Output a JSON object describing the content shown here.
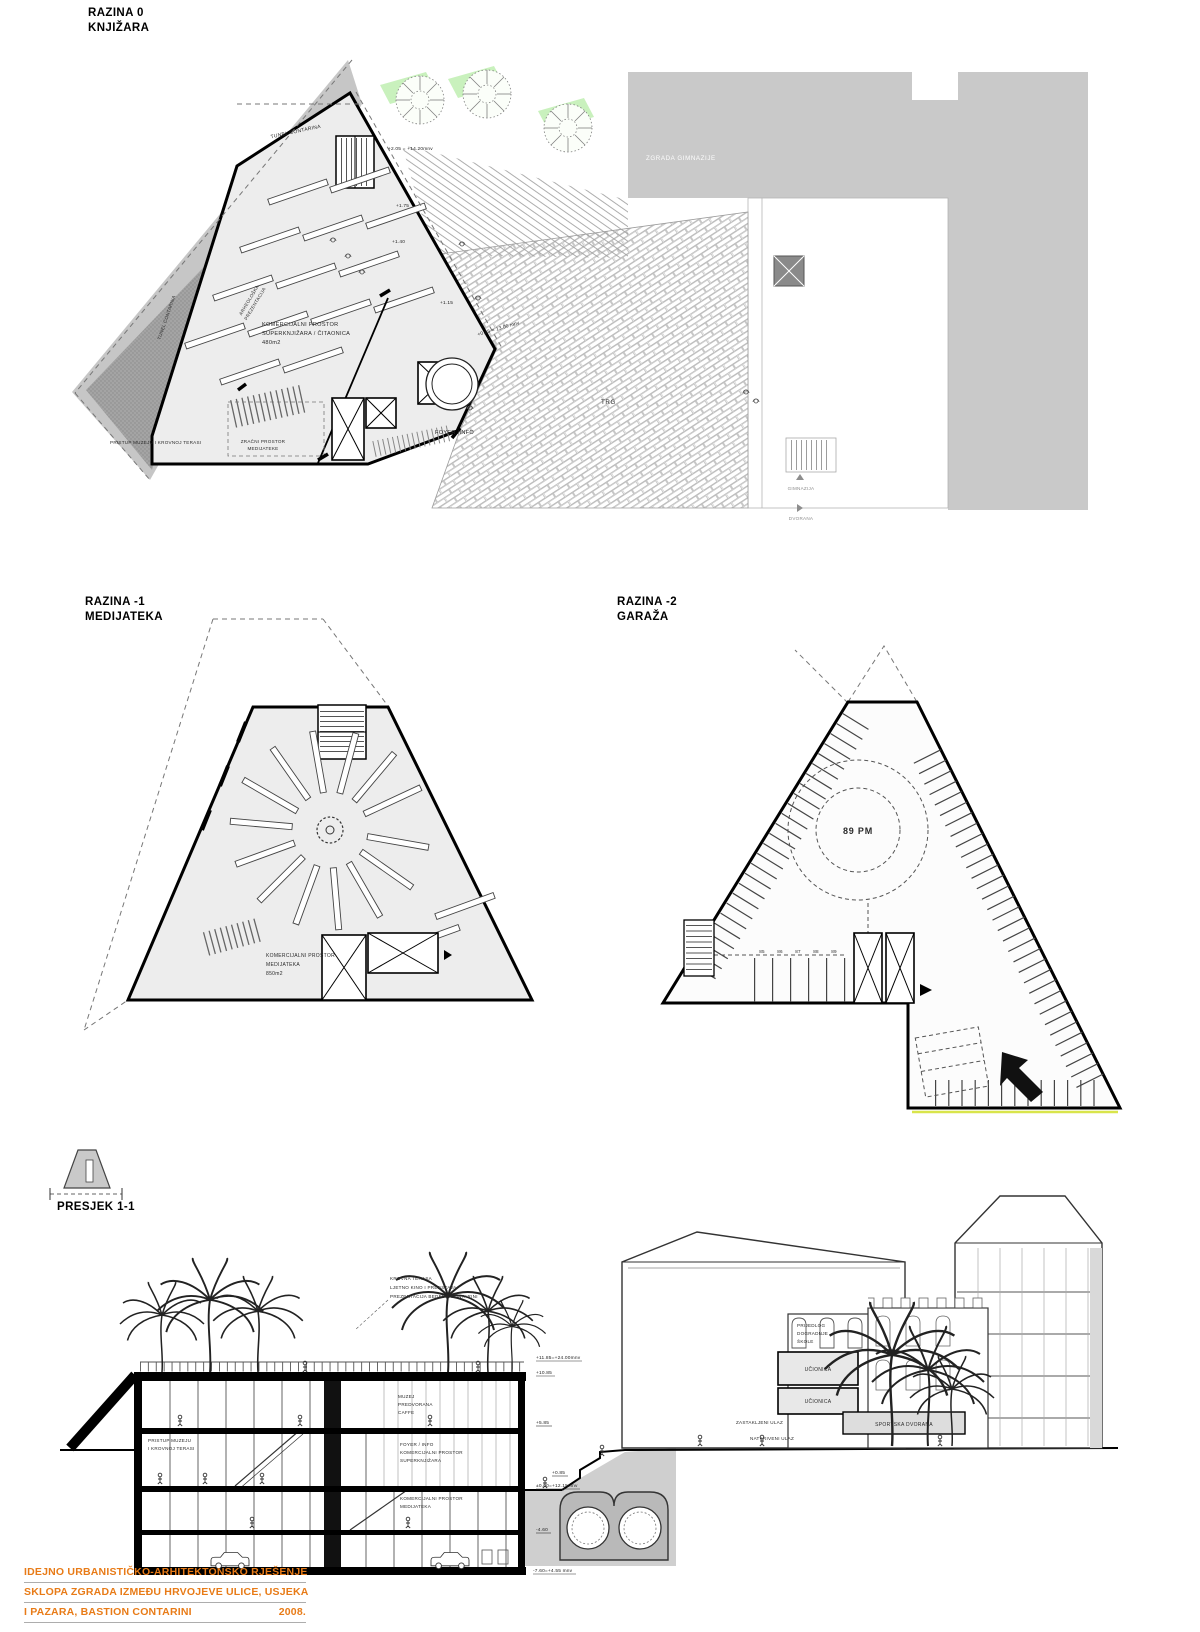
{
  "plan0": {
    "title": [
      "RAZINA 0",
      "KNJIŽARA"
    ],
    "tunel_top": "TUNEL CONTARINA",
    "tunel_side": "TUNEL CONTARINA",
    "arheo1": "ARHEOLOŠKA",
    "arheo2": "PREZENTACIJA",
    "kom1": "KOMERCIJALNI PROSTOR",
    "kom2": "SUPERKNJIŽARA / ČITAONICA",
    "kom3": "480m2",
    "pristup": "PRISTUP MUZEJU I KROVNOJ TERASI",
    "zracni1": "ZRAČNI PROSTOR",
    "zracni2": "MEDIJATEKE",
    "foyer": "FOYER /INFO",
    "trg": "TRG",
    "zgrada_gimnazije": "ZGRADA GIMNAZIJE",
    "gimnazija": "GIMNAZIJA",
    "dvorana": "DVORANA",
    "lev_top": "+2.05 = +14.20mnv",
    "lev_175": "+1.75",
    "lev_140": "+1.40",
    "lev_115": "+1.15",
    "lev_085": "+0.85 = 13.00 mnv"
  },
  "plan1": {
    "title": [
      "RAZINA -1",
      "MEDIJATEKA"
    ],
    "kom1": "KOMERCIJALNI PROSTOR",
    "kom2": "MEDIJATEKA",
    "kom3": "850m2"
  },
  "plan2": {
    "title": [
      "RAZINA -2",
      "GARAŽA"
    ],
    "capacity": "89 PM",
    "stalls": [
      "85",
      "86",
      "87",
      "88",
      "89"
    ]
  },
  "section": {
    "title": "PRESJEK 1-1",
    "krovna1": "KROVNA TERASA",
    "krovna2": "LJETNO KINO I PREDSTAVA",
    "krovna3": "PREZENTACIJA BEDEMA CONTARINI",
    "muzej1": "MUZEJ",
    "muzej2": "PREDVORANA",
    "muzej3": "CAFFE",
    "pristup1": "PRISTUP MUZEJU",
    "pristup2": "I KROVNOJ TERASI",
    "foyer1": "FOYER / INFO",
    "foyer2": "KOMERCIJALNI PROSTOR",
    "foyer3": "SUPERKNJIŽARA",
    "medij1": "KOMERCIJALNI PROSTOR",
    "medij2": "MEDIJATEKA",
    "prijedlog1": "PRIJEDLOG",
    "prijedlog2": "DOGRADNJE",
    "prijedlog3": "ŠKOLE",
    "ucionica1": "UČIONICA",
    "ucionica2": "UČIONICA",
    "zastakljeni": "ZASTAKLJENI ULAZ",
    "natkriveni": "NATKRIVENI ULAZ",
    "sportska": "SPORTSKA DVORANA",
    "lev_roof": "+11.85=+24.00mnv",
    "lev_roof2": "+10.85",
    "lev_mid": "+5.85",
    "lev_plaza": "+0.85",
    "lev_zero": "±0.00=+12.15mnv",
    "lev_b1": "-4.60",
    "lev_b2": "-7.60=+4.55 mnv"
  },
  "titleblock": {
    "line1": "IDEJNO URBANISTIČKO-ARHITEKTONSKO RJEŠENJE",
    "line2": "SKLOPA ZGRADA IZMEĐU HRVOJEVE ULICE, USJEKA",
    "line3": "I PAZARA, BASTION CONTARINI",
    "year": "2008.",
    "accent_color": "#e87b17"
  }
}
